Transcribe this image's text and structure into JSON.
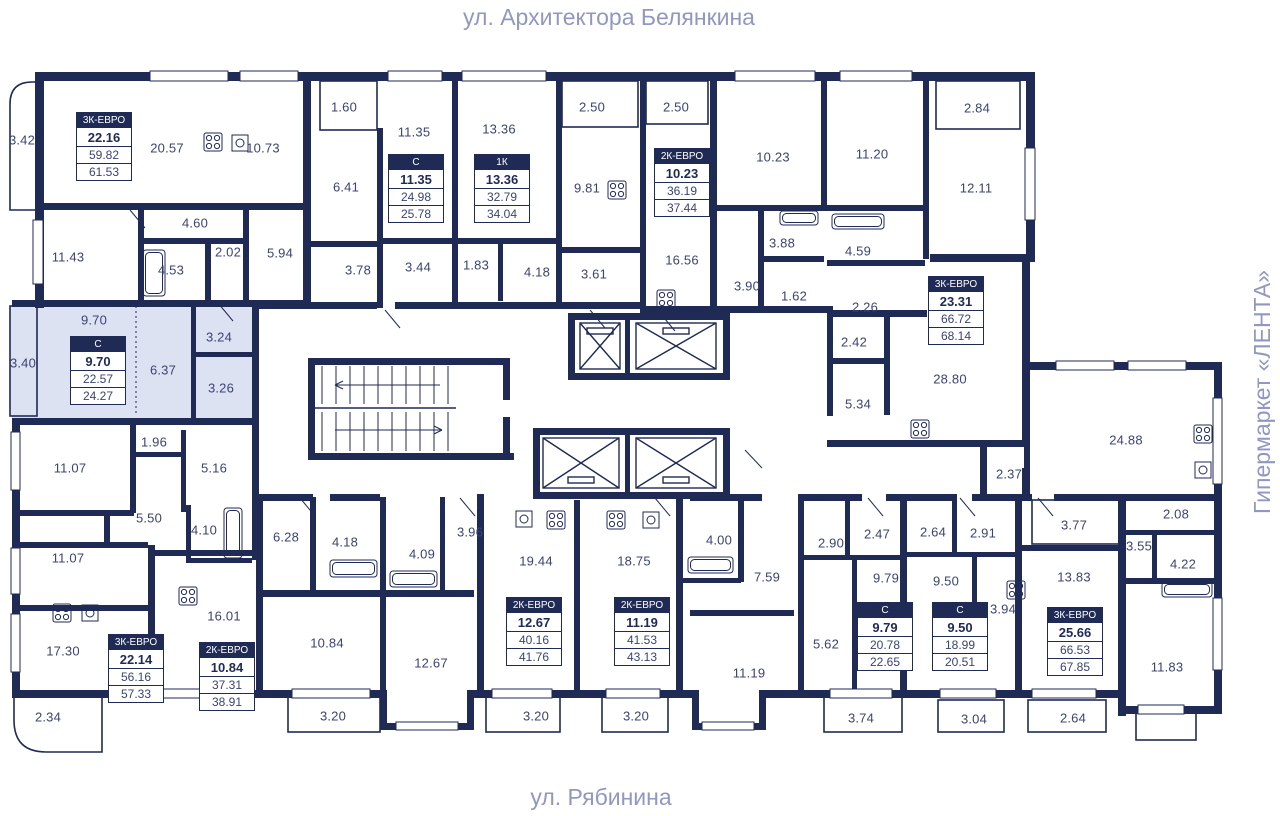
{
  "labels": {
    "street_top": "ул. Архитектора Белянкина",
    "street_bottom": "ул. Рябинина",
    "landmark_right": "Гипермаркет «ЛЕНТА»"
  },
  "colors": {
    "wall": "#1f2a55",
    "room_text": "#3b4471",
    "street_text": "#9297c1",
    "highlight_fill": "#dde2f3",
    "card_header_bg": "#1f2a55",
    "card_header_text": "#ffffff"
  },
  "apartments": [
    {
      "type": "3К-ЕВРО",
      "living": "22.16",
      "area": "59.82",
      "total": "61.53",
      "x": 76,
      "y": 112,
      "highlighted": false
    },
    {
      "type": "С",
      "living": "11.35",
      "area": "24.98",
      "total": "25.78",
      "x": 388,
      "y": 154,
      "highlighted": false
    },
    {
      "type": "1К",
      "living": "13.36",
      "area": "32.79",
      "total": "34.04",
      "x": 474,
      "y": 154,
      "highlighted": false
    },
    {
      "type": "2К-ЕВРО",
      "living": "10.23",
      "area": "36.19",
      "total": "37.44",
      "x": 654,
      "y": 148,
      "highlighted": false
    },
    {
      "type": "3К-ЕВРО",
      "living": "23.31",
      "area": "66.72",
      "total": "68.14",
      "x": 928,
      "y": 276,
      "highlighted": false
    },
    {
      "type": "С",
      "living": "9.70",
      "area": "22.57",
      "total": "24.27",
      "x": 70,
      "y": 336,
      "highlighted": true
    },
    {
      "type": "3К-ЕВРО",
      "living": "22.14",
      "area": "56.16",
      "total": "57.33",
      "x": 108,
      "y": 634,
      "highlighted": false
    },
    {
      "type": "2К-ЕВРО",
      "living": "10.84",
      "area": "37.31",
      "total": "38.91",
      "x": 199,
      "y": 642,
      "highlighted": false
    },
    {
      "type": "2К-ЕВРО",
      "living": "12.67",
      "area": "40.16",
      "total": "41.76",
      "x": 506,
      "y": 597,
      "highlighted": false
    },
    {
      "type": "2К-ЕВРО",
      "living": "11.19",
      "area": "41.53",
      "total": "43.13",
      "x": 614,
      "y": 597,
      "highlighted": false
    },
    {
      "type": "С",
      "living": "9.79",
      "area": "20.78",
      "total": "22.65",
      "x": 857,
      "y": 602,
      "highlighted": false
    },
    {
      "type": "С",
      "living": "9.50",
      "area": "18.99",
      "total": "20.51",
      "x": 932,
      "y": 602,
      "highlighted": false
    },
    {
      "type": "3К-ЕВРО",
      "living": "25.66",
      "area": "66.53",
      "total": "67.85",
      "x": 1047,
      "y": 607,
      "highlighted": false
    }
  ],
  "rooms": [
    {
      "label": "3.42",
      "x": 22,
      "y": 140
    },
    {
      "label": "20.57",
      "x": 167,
      "y": 148
    },
    {
      "label": "10.73",
      "x": 263,
      "y": 148
    },
    {
      "label": "1.60",
      "x": 344,
      "y": 107
    },
    {
      "label": "11.35",
      "x": 414,
      "y": 132
    },
    {
      "label": "13.36",
      "x": 499,
      "y": 129
    },
    {
      "label": "2.50",
      "x": 592,
      "y": 107
    },
    {
      "label": "2.50",
      "x": 676,
      "y": 107
    },
    {
      "label": "10.23",
      "x": 773,
      "y": 157
    },
    {
      "label": "11.20",
      "x": 872,
      "y": 154
    },
    {
      "label": "2.84",
      "x": 977,
      "y": 108
    },
    {
      "label": "12.11",
      "x": 976,
      "y": 188
    },
    {
      "label": "11.43",
      "x": 68,
      "y": 257
    },
    {
      "label": "4.60",
      "x": 195,
      "y": 223
    },
    {
      "label": "4.53",
      "x": 171,
      "y": 270
    },
    {
      "label": "2.02",
      "x": 228,
      "y": 252
    },
    {
      "label": "5.94",
      "x": 280,
      "y": 253
    },
    {
      "label": "6.41",
      "x": 346,
      "y": 187
    },
    {
      "label": "3.78",
      "x": 358,
      "y": 270
    },
    {
      "label": "3.44",
      "x": 418,
      "y": 267
    },
    {
      "label": "1.83",
      "x": 476,
      "y": 265
    },
    {
      "label": "4.18",
      "x": 537,
      "y": 272
    },
    {
      "label": "9.81",
      "x": 587,
      "y": 188
    },
    {
      "label": "3.61",
      "x": 594,
      "y": 274
    },
    {
      "label": "16.56",
      "x": 682,
      "y": 260
    },
    {
      "label": "3.88",
      "x": 782,
      "y": 243
    },
    {
      "label": "3.90",
      "x": 747,
      "y": 286
    },
    {
      "label": "1.62",
      "x": 794,
      "y": 296
    },
    {
      "label": "4.59",
      "x": 858,
      "y": 251
    },
    {
      "label": "2.26",
      "x": 865,
      "y": 307
    },
    {
      "label": "9.70",
      "x": 94,
      "y": 320
    },
    {
      "label": "3.40",
      "x": 23,
      "y": 363
    },
    {
      "label": "3.24",
      "x": 219,
      "y": 337
    },
    {
      "label": "6.37",
      "x": 163,
      "y": 370
    },
    {
      "label": "3.26",
      "x": 221,
      "y": 388
    },
    {
      "label": "2.42",
      "x": 854,
      "y": 342
    },
    {
      "label": "5.34",
      "x": 858,
      "y": 404
    },
    {
      "label": "28.80",
      "x": 950,
      "y": 379
    },
    {
      "label": "24.88",
      "x": 1126,
      "y": 440
    },
    {
      "label": "2.37",
      "x": 1009,
      "y": 474
    },
    {
      "label": "1.96",
      "x": 154,
      "y": 442
    },
    {
      "label": "11.07",
      "x": 70,
      "y": 468
    },
    {
      "label": "5.16",
      "x": 214,
      "y": 468
    },
    {
      "label": "5.50",
      "x": 149,
      "y": 518
    },
    {
      "label": "4.10",
      "x": 204,
      "y": 530
    },
    {
      "label": "6.28",
      "x": 286,
      "y": 537
    },
    {
      "label": "4.18",
      "x": 345,
      "y": 542
    },
    {
      "label": "4.09",
      "x": 422,
      "y": 554
    },
    {
      "label": "3.96",
      "x": 470,
      "y": 532
    },
    {
      "label": "3.77",
      "x": 1074,
      "y": 525
    },
    {
      "label": "2.08",
      "x": 1176,
      "y": 514
    },
    {
      "label": "3.55",
      "x": 1139,
      "y": 546
    },
    {
      "label": "2.90",
      "x": 831,
      "y": 543
    },
    {
      "label": "2.47",
      "x": 877,
      "y": 534
    },
    {
      "label": "2.64",
      "x": 933,
      "y": 532
    },
    {
      "label": "2.91",
      "x": 983,
      "y": 533
    },
    {
      "label": "4.00",
      "x": 719,
      "y": 540
    },
    {
      "label": "7.59",
      "x": 767,
      "y": 577
    },
    {
      "label": "5.62",
      "x": 826,
      "y": 644
    },
    {
      "label": "19.44",
      "x": 536,
      "y": 561
    },
    {
      "label": "18.75",
      "x": 634,
      "y": 561
    },
    {
      "label": "11.07",
      "x": 68,
      "y": 558
    },
    {
      "label": "17.30",
      "x": 63,
      "y": 651
    },
    {
      "label": "2.34",
      "x": 48,
      "y": 717
    },
    {
      "label": "16.01",
      "x": 224,
      "y": 616
    },
    {
      "label": "10.84",
      "x": 327,
      "y": 643
    },
    {
      "label": "12.67",
      "x": 431,
      "y": 663
    },
    {
      "label": "9.79",
      "x": 886,
      "y": 578
    },
    {
      "label": "9.50",
      "x": 946,
      "y": 581
    },
    {
      "label": "3.94",
      "x": 1003,
      "y": 609
    },
    {
      "label": "13.83",
      "x": 1074,
      "y": 577
    },
    {
      "label": "11.19",
      "x": 749,
      "y": 673
    },
    {
      "label": "4.22",
      "x": 1183,
      "y": 564
    },
    {
      "label": "11.83",
      "x": 1167,
      "y": 667
    },
    {
      "label": "3.20",
      "x": 333,
      "y": 716
    },
    {
      "label": "3.20",
      "x": 536,
      "y": 716
    },
    {
      "label": "3.20",
      "x": 636,
      "y": 716
    },
    {
      "label": "3.74",
      "x": 861,
      "y": 718
    },
    {
      "label": "3.04",
      "x": 974,
      "y": 719
    },
    {
      "label": "2.64",
      "x": 1073,
      "y": 718
    }
  ]
}
